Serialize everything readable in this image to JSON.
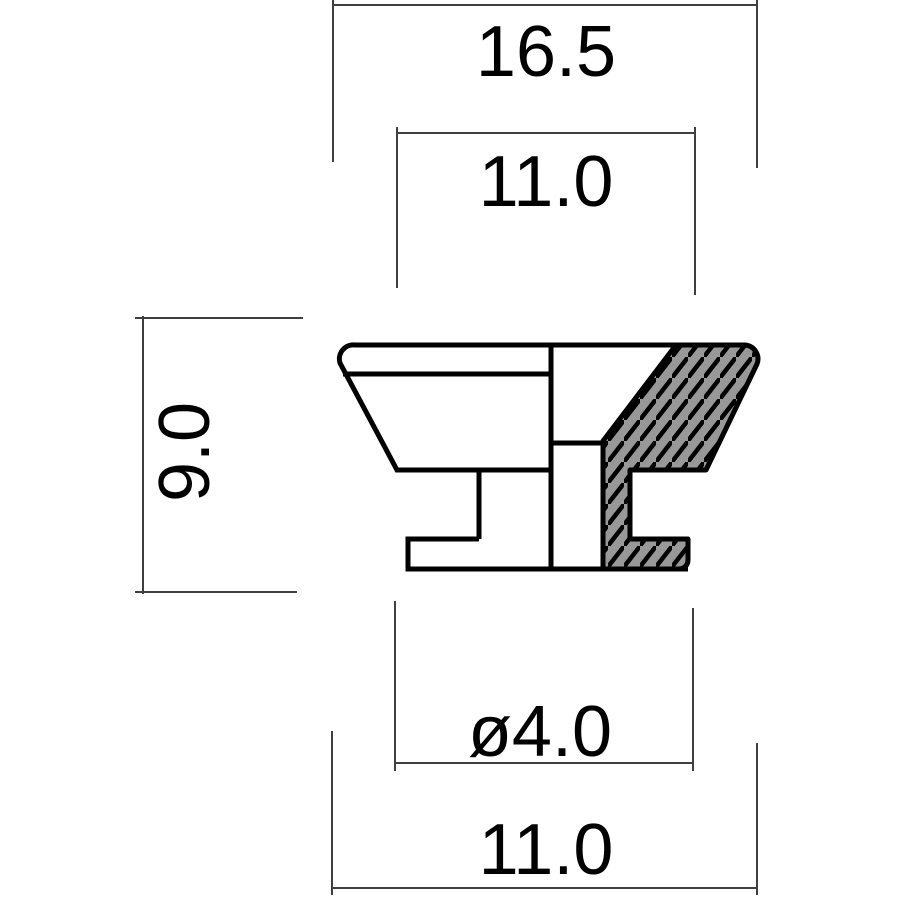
{
  "drawing": {
    "kind": "technical cross-section drawing of flanged bushing / nozzle part",
    "labels": {
      "overall_top_width": "16.5",
      "upper_inner_width": "11.0",
      "height": "9.0",
      "hole_diameter": "ø4.0",
      "lower_width": "11.0"
    },
    "colors": {
      "outline": "#000000",
      "hatch_fill": "#989898",
      "hatch_stroke": "#000000",
      "dimension_line": "#3f3f3f",
      "label_text": "#000000",
      "background": "#ffffff"
    }
  }
}
